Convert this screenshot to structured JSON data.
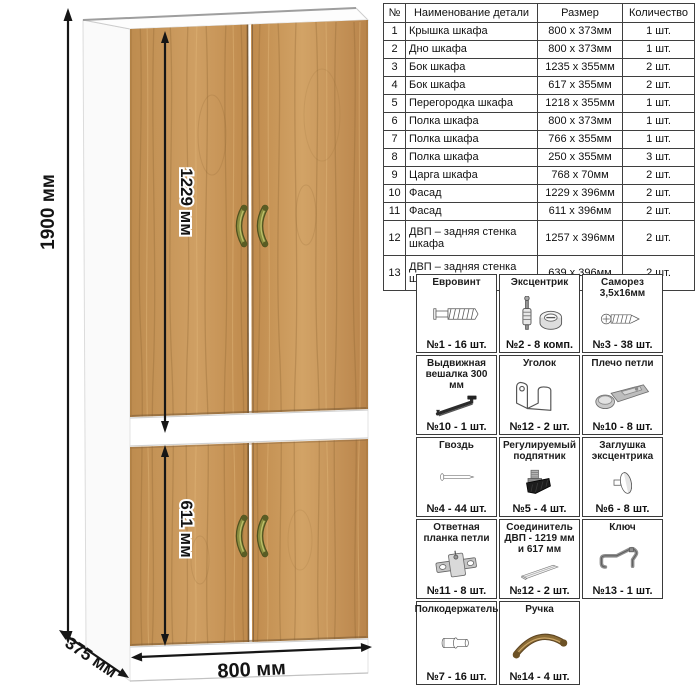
{
  "wardrobe": {
    "dimensions": {
      "height": "1900 мм",
      "upper_facade_height": "1229 мм",
      "lower_facade_height": "611 мм",
      "width": "800 мм",
      "depth": "375 мм"
    },
    "colors": {
      "wood_base": "#c3914f",
      "wood_dark": "#8d6532",
      "wood_light": "#dcae70",
      "carcass": "#ffffff",
      "handle": "#7c7f38",
      "dimension": "#141414"
    }
  },
  "parts_table": {
    "headers": {
      "num": "№",
      "name": "Наименование детали",
      "size": "Размер",
      "qty": "Количество"
    },
    "rows": [
      {
        "num": "1",
        "name": "Крышка шкафа",
        "size": "800 x 373мм",
        "qty": "1 шт."
      },
      {
        "num": "2",
        "name": "Дно шкафа",
        "size": "800 x 373мм",
        "qty": "1 шт."
      },
      {
        "num": "3",
        "name": "Бок шкафа",
        "size": "1235 x 355мм",
        "qty": "2 шт."
      },
      {
        "num": "4",
        "name": "Бок шкафа",
        "size": "617 x 355мм",
        "qty": "2 шт."
      },
      {
        "num": "5",
        "name": "Перегородка шкафа",
        "size": "1218 x 355мм",
        "qty": "1 шт."
      },
      {
        "num": "6",
        "name": "Полка шкафа",
        "size": "800 x 373мм",
        "qty": "1 шт."
      },
      {
        "num": "7",
        "name": "Полка шкафа",
        "size": "766 x 355мм",
        "qty": "1 шт."
      },
      {
        "num": "8",
        "name": "Полка шкафа",
        "size": "250 x 355мм",
        "qty": "3 шт."
      },
      {
        "num": "9",
        "name": "Царга шкафа",
        "size": "768 x 70мм",
        "qty": "2 шт."
      },
      {
        "num": "10",
        "name": "Фасад",
        "size": "1229 x 396мм",
        "qty": "2 шт."
      },
      {
        "num": "11",
        "name": "Фасад",
        "size": "611 x 396мм",
        "qty": "2 шт."
      },
      {
        "num": "12",
        "name": "ДВП – задняя стенка шкафа",
        "size": "1257 x 396мм",
        "qty": "2 шт."
      },
      {
        "num": "13",
        "name": "ДВП – задняя стенка шкафа",
        "size": "639 x 396мм",
        "qty": "2 шт."
      }
    ]
  },
  "hardware": {
    "items": [
      {
        "title": "Евровинт",
        "qty": "№1 - 16 шт."
      },
      {
        "title": "Эксцентрик",
        "qty": "№2 - 8 комп."
      },
      {
        "title": "Саморез 3,5х16мм",
        "qty": "№3 - 38 шт."
      },
      {
        "title": "Выдвижная вешалка 300 мм",
        "qty": "№10 - 1 шт."
      },
      {
        "title": "Уголок",
        "qty": "№12 - 2 шт."
      },
      {
        "title": "Плечо петли",
        "qty": "№10 - 8 шт."
      },
      {
        "title": "Гвоздь",
        "qty": "№4 - 44 шт."
      },
      {
        "title": "Регулируемый подпятник",
        "qty": "№5 - 4 шт."
      },
      {
        "title": "Заглушка эксцентрика",
        "qty": "№6 - 8 шт."
      },
      {
        "title": "Ответная планка петли",
        "qty": "№11 - 8 шт."
      },
      {
        "title": "Соединитель ДВП - 1219 мм и 617 мм",
        "qty": "№12 - 2 шт."
      },
      {
        "title": "Ключ",
        "qty": "№13 - 1 шт."
      },
      {
        "title": "Полкодержатель",
        "qty": "№7 - 16 шт."
      },
      {
        "title": "Ручка",
        "qty": "№14 - 4 шт."
      }
    ]
  }
}
